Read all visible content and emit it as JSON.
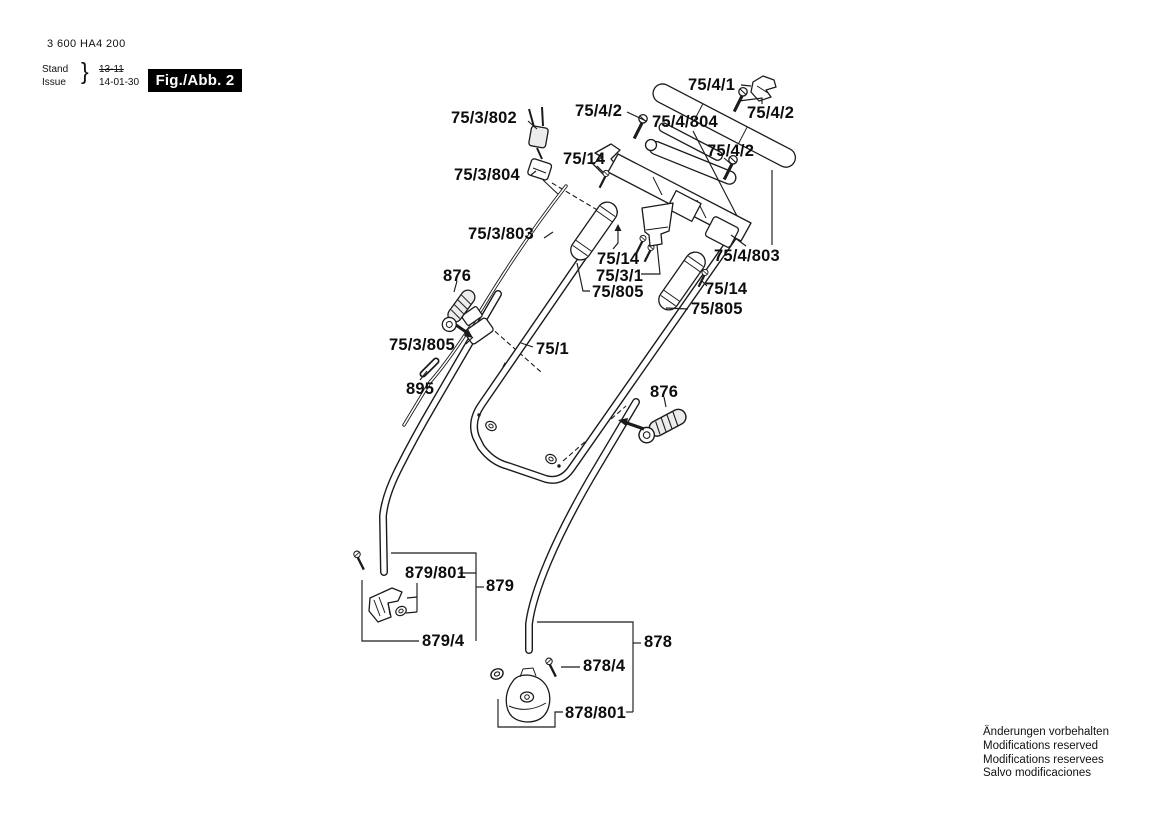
{
  "doc": {
    "part_number": "3 600 HA4 200",
    "stand_label": "Stand",
    "issue_label": "Issue",
    "brace": "}",
    "stand_value": "13-11",
    "issue_value": "14-01-30",
    "figure_label": "Fig./Abb. 2"
  },
  "notes": {
    "line1": "Änderungen vorbehalten",
    "line2": "Modifications reserved",
    "line3": "Modifications reservees",
    "line4": "Salvo modificaciones"
  },
  "diagram": {
    "labels": [
      {
        "id": "75-4-1",
        "text": "75/4/1"
      },
      {
        "id": "75-4-2-a",
        "text": "75/4/2"
      },
      {
        "id": "75-4-804",
        "text": "75/4/804"
      },
      {
        "id": "75-4-2-b",
        "text": "75/4/2"
      },
      {
        "id": "75-4-2-c",
        "text": "75/4/2"
      },
      {
        "id": "75-14-a",
        "text": "75/14"
      },
      {
        "id": "75-3-802",
        "text": "75/3/802"
      },
      {
        "id": "75-3-804",
        "text": "75/3/804"
      },
      {
        "id": "75-3-803",
        "text": "75/3/803"
      },
      {
        "id": "75-14-b",
        "text": "75/14"
      },
      {
        "id": "75-3-1",
        "text": "75/3/1"
      },
      {
        "id": "75-805-a",
        "text": "75/805"
      },
      {
        "id": "75-4-803",
        "text": "75/4/803"
      },
      {
        "id": "75-14-c",
        "text": "75/14"
      },
      {
        "id": "75-805-b",
        "text": "75/805"
      },
      {
        "id": "876-a",
        "text": "876"
      },
      {
        "id": "75-3-805",
        "text": "75/3/805"
      },
      {
        "id": "75-1",
        "text": "75/1"
      },
      {
        "id": "895",
        "text": "895"
      },
      {
        "id": "876-b",
        "text": "876"
      },
      {
        "id": "879-801",
        "text": "879/801"
      },
      {
        "id": "879",
        "text": "879"
      },
      {
        "id": "879-4",
        "text": "879/4"
      },
      {
        "id": "878",
        "text": "878"
      },
      {
        "id": "878-4",
        "text": "878/4"
      },
      {
        "id": "878-801",
        "text": "878/801"
      }
    ]
  }
}
